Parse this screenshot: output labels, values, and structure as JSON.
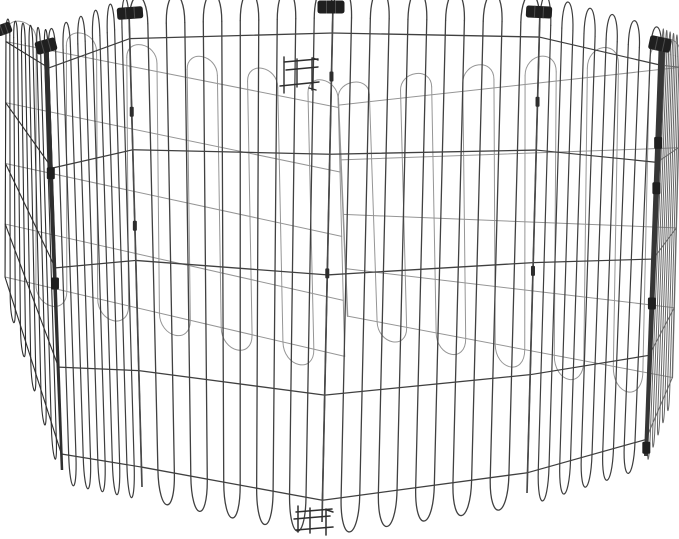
{
  "canvas": {
    "width": 679,
    "height": 539,
    "background": "#ffffff"
  },
  "subject": "black-metal-wire-octagonal-pet-exercise-pen-product-photo",
  "colors": {
    "background": "#ffffff",
    "wire_front": "#404040",
    "wire_mid": "#3e3e3e",
    "wire_side": "#2f2f2f",
    "wire_back": "#8d8d8d",
    "wire_edge": "#666666",
    "frame_bar": "#363636",
    "clip": "#1f1f1f",
    "rod": "#4a4a4a",
    "latch": "#2e2e2e"
  },
  "pen": {
    "vertices_top": [
      [
        333,
        4
      ],
      [
        540,
        10
      ],
      [
        662,
        42
      ],
      [
        681,
        48
      ],
      [
        338,
        92
      ],
      [
        6,
        27
      ],
      [
        48,
        44
      ],
      [
        129,
        12
      ]
    ],
    "vertices_bottom": [
      [
        322,
        522
      ],
      [
        527,
        493
      ],
      [
        645,
        457
      ],
      [
        672,
        392
      ],
      [
        345,
        368
      ],
      [
        5,
        288
      ],
      [
        62,
        472
      ],
      [
        142,
        487
      ]
    ],
    "wire_top": 0.026,
    "wire_bottom": 0.958,
    "arch_ctrl": -0.052,
    "foot_ctrl": 1.05,
    "horizontal_fractions": [
      0.056,
      0.29,
      0.523,
      0.755,
      0.958
    ],
    "verticals_per_panel": 12,
    "panels": [
      {
        "name": "back-right-door-panel",
        "from": 3,
        "to": 4,
        "stroke": "#8d8d8d",
        "w": 1.0,
        "op": 0.92,
        "bo": [
          [
            672,
            392
          ],
          [
            348,
            326
          ]
        ],
        "heavy": true
      },
      {
        "name": "back-left-panel",
        "from": 4,
        "to": 5,
        "stroke": "#8d8d8d",
        "w": 1.0,
        "op": 0.92
      },
      {
        "name": "right-edge-panel",
        "from": 2,
        "to": 3,
        "stroke": "#666666",
        "w": 1.0,
        "op": 1
      },
      {
        "name": "left-side-panel",
        "from": 5,
        "to": 6,
        "stroke": "#2f2f2f",
        "w": 1.1,
        "op": 1
      },
      {
        "name": "left-front-panel",
        "from": 6,
        "to": 7,
        "stroke": "#3e3e3e",
        "w": 1.2,
        "op": 1
      },
      {
        "name": "front-left-panel",
        "from": 7,
        "to": 0,
        "stroke": "#404040",
        "w": 1.3,
        "op": 1
      },
      {
        "name": "front-right-panel",
        "from": 0,
        "to": 1,
        "stroke": "#404040",
        "w": 1.3,
        "op": 1
      },
      {
        "name": "right-front-panel",
        "from": 1,
        "to": 2,
        "stroke": "#3e3e3e",
        "w": 1.2,
        "op": 1
      }
    ],
    "rods": [
      {
        "junction": 7,
        "sleeves": [
          0.21,
          0.45
        ]
      },
      {
        "junction": 0,
        "sleeves": [
          0.14,
          0.52
        ]
      },
      {
        "junction": 1,
        "sleeves": [
          0.19,
          0.54
        ]
      }
    ],
    "clips": [
      {
        "name": "hinge-clip-back-left",
        "cx": 4,
        "cy": 29,
        "w": 15,
        "h": 11,
        "angle": -20
      },
      {
        "name": "hinge-clip-left",
        "cx": 46,
        "cy": 46,
        "w": 21,
        "h": 13,
        "angle": -15
      },
      {
        "name": "hinge-clip-front-left",
        "cx": 130,
        "cy": 13,
        "w": 26,
        "h": 12,
        "angle": -4
      },
      {
        "name": "hinge-clip-front-center",
        "cx": 331,
        "cy": 7,
        "w": 27,
        "h": 13,
        "angle": 0
      },
      {
        "name": "hinge-clip-front-right",
        "cx": 539,
        "cy": 12,
        "w": 26,
        "h": 12,
        "angle": 3
      },
      {
        "name": "hinge-clip-right",
        "cx": 660,
        "cy": 44,
        "w": 22,
        "h": 14,
        "angle": 12
      }
    ],
    "bars": [
      {
        "name": "left-frame-bar",
        "x1": 46,
        "y1": 46,
        "x2": 62,
        "y2": 470,
        "w1": 5.0,
        "w2": 2.5,
        "color": "#2f2f2f",
        "knuckles": [
          0.3,
          0.56
        ]
      },
      {
        "name": "right-frame-bar",
        "x1": 662,
        "y1": 44,
        "x2": 646,
        "y2": 456,
        "w1": 6.5,
        "w2": 4.0,
        "color": "#363636",
        "knuckles": [
          0.24,
          0.35,
          0.63,
          0.98
        ]
      }
    ],
    "latches": [
      {
        "name": "door-latch-top",
        "w": 1.4,
        "segments": [
          [
            284,
            57,
            284,
            93
          ],
          [
            312,
            58,
            312,
            90
          ],
          [
            297,
            59,
            297,
            87
          ],
          [
            284,
            62,
            318,
            59
          ],
          [
            286,
            70,
            318,
            67
          ],
          [
            280,
            86,
            319,
            82
          ],
          [
            313,
            58,
            318,
            60
          ],
          [
            309,
            88,
            316,
            90
          ]
        ]
      },
      {
        "name": "door-latch-bottom",
        "w": 1.5,
        "segments": [
          [
            298,
            506,
            298,
            532
          ],
          [
            326,
            509,
            326,
            535
          ],
          [
            310,
            508,
            310,
            533
          ],
          [
            296,
            512,
            332,
            509
          ],
          [
            294,
            519,
            330,
            516
          ],
          [
            296,
            530,
            333,
            527
          ],
          [
            327,
            510,
            333,
            512
          ]
        ]
      }
    ]
  }
}
